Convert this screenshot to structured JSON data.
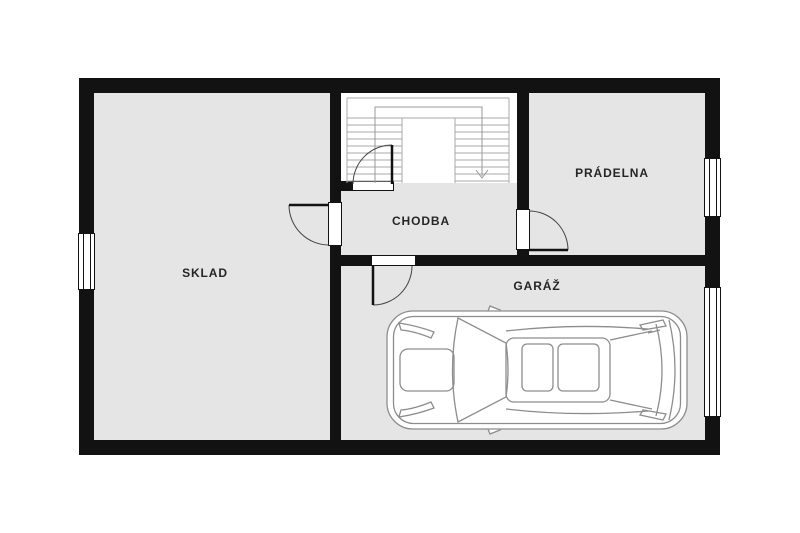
{
  "plan": {
    "title": "floor-plan",
    "rooms": [
      {
        "id": "sklad",
        "label": "SKLAD"
      },
      {
        "id": "chodba",
        "label": "CHODBA"
      },
      {
        "id": "pradelna",
        "label": "PRÁDELNA"
      },
      {
        "id": "garaz",
        "label": "GARÁŽ"
      }
    ],
    "stairs": {
      "flights": 2,
      "direction_arrow": "down"
    },
    "features": [
      "car-top-view-in-garage",
      "left-window",
      "pradelna-window",
      "garage-entry-right",
      "4-interior-doors"
    ],
    "colors": {
      "wall": "#121212",
      "floor": "#e5e5e5",
      "background": "#ffffff",
      "stair_line": "#a8a8a8",
      "walk_line": "#999999",
      "door_arc": "#444444",
      "car_line": "#8d8d8d",
      "label": "#262626"
    }
  }
}
